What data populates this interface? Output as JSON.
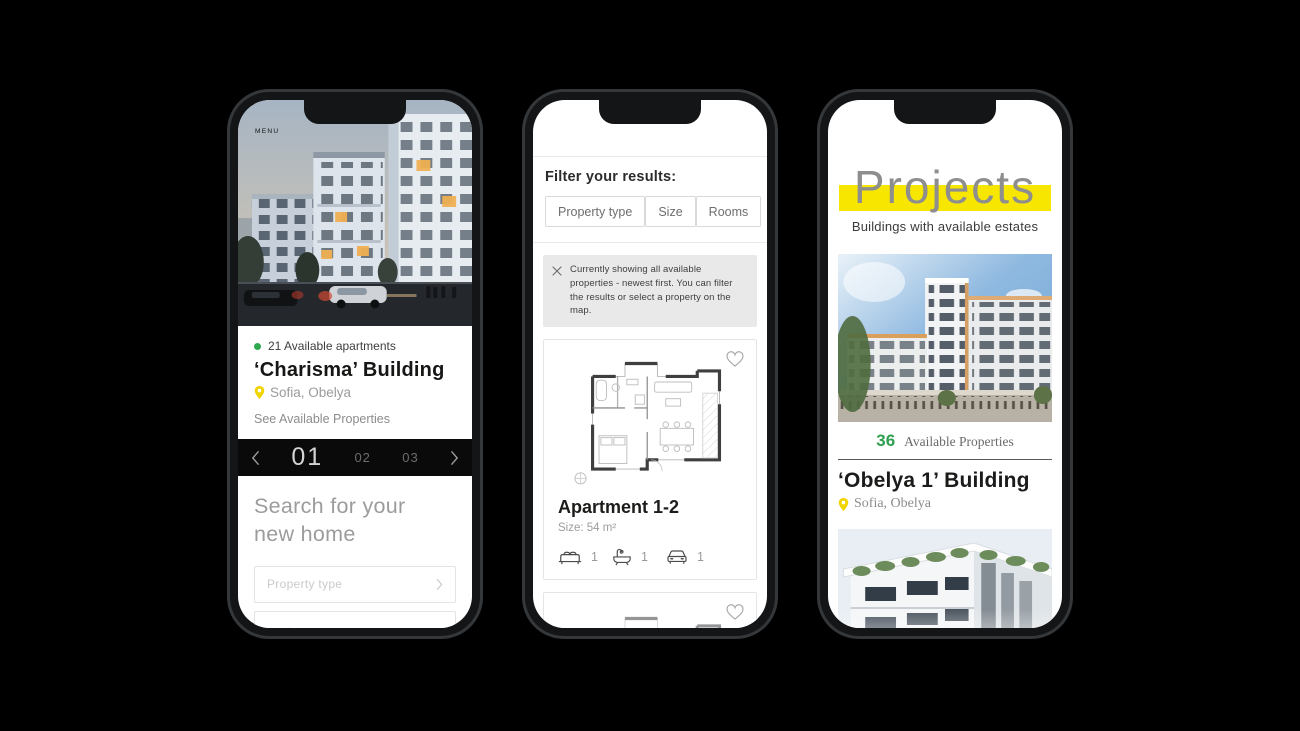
{
  "colors": {
    "accent_yellow": "#F7E600",
    "green": "#2FA84F",
    "pin_yellow": "#F0D500",
    "carousel_bg": "#0a0a0b"
  },
  "phone1": {
    "menu_label": "MENU",
    "status": "21 Available apartments",
    "title": "‘Charisma’ Building",
    "location": "Sofia, Obelya",
    "link": "See Available Properties",
    "carousel": {
      "active": "01",
      "items": [
        "01",
        "02",
        "03"
      ]
    },
    "search_heading": "Search for your new home",
    "inputs": [
      {
        "placeholder": "Property type"
      },
      {
        "placeholder": "Surface"
      }
    ]
  },
  "phone2": {
    "filter_heading": "Filter your results:",
    "filters": [
      "Property type",
      "Size",
      "Rooms"
    ],
    "notice": "Currently showing all available properties - newest first. You can filter the results or select a property on the map.",
    "card": {
      "title": "Apartment 1-2",
      "size": "Size: 54 m²",
      "features": [
        {
          "icon": "bed-icon",
          "count": "1"
        },
        {
          "icon": "bath-icon",
          "count": "1"
        },
        {
          "icon": "car-icon",
          "count": "1"
        }
      ]
    }
  },
  "phone3": {
    "title": "Projects",
    "subtitle": "Buildings with available estates",
    "project": {
      "count": "36",
      "count_label": "Available Properties",
      "title": "‘Obelya 1’ Building",
      "location": "Sofia, Obelya"
    }
  }
}
